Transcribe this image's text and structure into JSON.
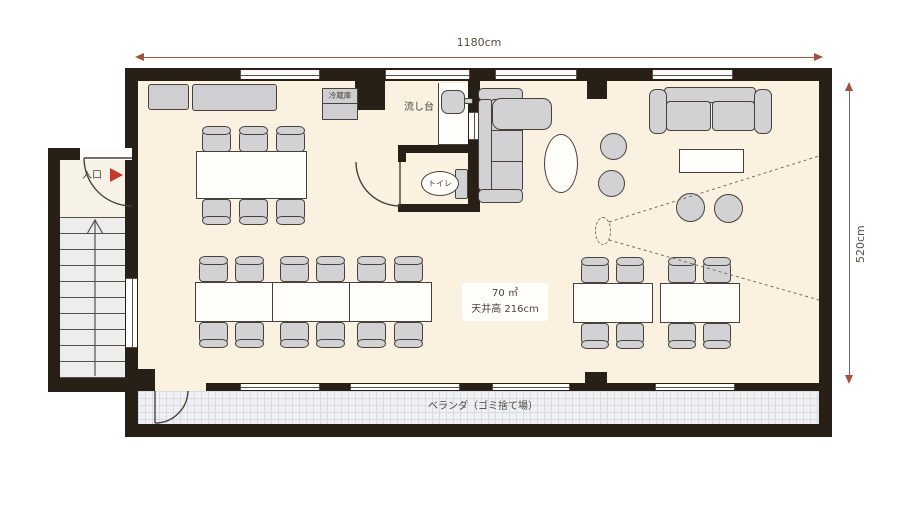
{
  "dimensions": {
    "width_label": "1180cm",
    "height_label": "520cm"
  },
  "room_info": {
    "area": "70 ㎡",
    "ceiling_height": "天井高 216cm"
  },
  "labels": {
    "entrance": "入口",
    "refrigerator": "冷蔵庫",
    "sink": "流し台",
    "toilet": "トイレ",
    "veranda": "ベランダ（ゴミ捨て場）"
  },
  "colors": {
    "wall": "#281f17",
    "floor": "#faf1e0",
    "furniture_gray": "#d2d2d4",
    "outline": "#46413a",
    "dimension_line": "#a0523d",
    "entrance_arrow": "#c0392b",
    "balcony_tile": "#eef0f4"
  }
}
